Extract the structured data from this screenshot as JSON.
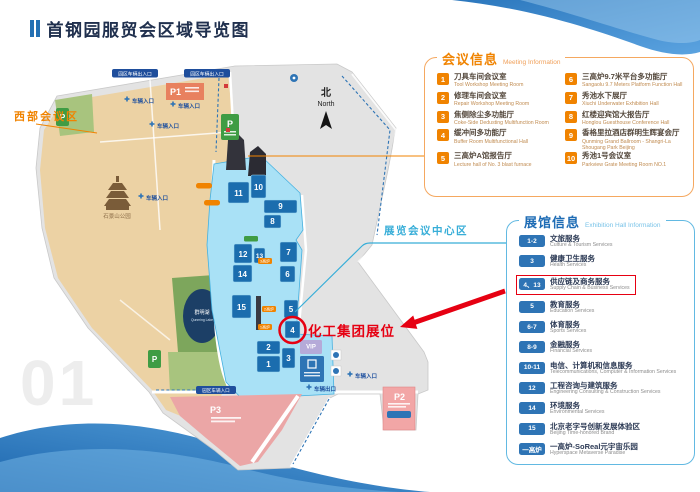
{
  "page": {
    "title": "首钢园服贸会区域导览图",
    "watermark": "01"
  },
  "colors": {
    "accent_orange": "#f08300",
    "accent_blue": "#2e74b5",
    "highlight_red": "#e60012",
    "teal": "#38aed8"
  },
  "map": {
    "region_west": "西部会议区",
    "region_center": "展览会议中心区",
    "compass": {
      "zh": "北",
      "en": "North"
    },
    "annotation_booth": "化工集团展位",
    "park_name": "石景山公园",
    "lake": {
      "zh": "群明湖",
      "en": "Qunming Lake"
    },
    "entrances": {
      "gate_inout": "园区车辆出入口",
      "gate_in": "园区车辆入口",
      "vehicle_in": "车辆入口",
      "vehicle_out": "车辆出口"
    },
    "parking": {
      "p1": "P1",
      "p2": "P2",
      "p3": "P3",
      "p": "P"
    },
    "buildings": {
      "n1": "1",
      "n2": "2",
      "n3": "3",
      "n4": "4",
      "n5": "5",
      "n6": "6",
      "n7": "7",
      "n8": "8",
      "n9": "9",
      "n10": "10",
      "n11": "11",
      "n12": "12",
      "n13": "13",
      "n14": "14",
      "n15": "15",
      "vip": "VIP"
    },
    "furnaces": {
      "f1": "1高炉",
      "f2": "2高炉",
      "f3": "3高炉"
    }
  },
  "meeting_info": {
    "title_zh": "会议信息",
    "title_en": "Meeting Information",
    "items": [
      {
        "num": "1",
        "zh": "刀具车间会议室",
        "en": "Tool Workshop Meeting Room"
      },
      {
        "num": "2",
        "zh": "修理车间会议室",
        "en": "Repair Workshop Meeting Room"
      },
      {
        "num": "3",
        "zh": "焦侧除尘多功能厅",
        "en": "Coke-Side Dedusting Multifunction Room"
      },
      {
        "num": "4",
        "zh": "缓冲间多功能厅",
        "en": "Buffer Room Multifunctional Hall"
      },
      {
        "num": "5",
        "zh": "三高炉A馆报告厅",
        "en": "Lecture hall of No. 3 blast furnace"
      },
      {
        "num": "6",
        "zh": "三高炉9.7米平台多功能厅",
        "en": "Sangaolu 9.7 Meters Platform Function Hall"
      },
      {
        "num": "7",
        "zh": "秀池水下展厅",
        "en": "Xiuchi Underwater Exhibition Hall"
      },
      {
        "num": "8",
        "zh": "红楼迎宾馆大报告厅",
        "en": "Honglou Guesthouse Conference Hall"
      },
      {
        "num": "9",
        "zh": "香格里拉酒店群明生辉宴会厅",
        "en": "Qunming Grand Ballroom - Shangri-La Shougang Park Beijing"
      },
      {
        "num": "10",
        "zh": "秀池1号会议室",
        "en": "Parkview Grate Meeting Room NO.1"
      }
    ]
  },
  "hall_info": {
    "title_zh": "展馆信息",
    "title_en": "Exhibition Hall Information",
    "items": [
      {
        "badge": "1-2",
        "zh": "文旅服务",
        "en": "Culture & Tourism Services",
        "highlight": false
      },
      {
        "badge": "3",
        "zh": "健康卫生服务",
        "en": "Health Services",
        "highlight": false
      },
      {
        "badge": "4、13",
        "zh": "供应链及商务服务",
        "en": "Supply Chain & Business Services",
        "highlight": true
      },
      {
        "badge": "5",
        "zh": "教育服务",
        "en": "Education Services",
        "highlight": false
      },
      {
        "badge": "6-7",
        "zh": "体育服务",
        "en": "Sports Services",
        "highlight": false
      },
      {
        "badge": "8-9",
        "zh": "金融服务",
        "en": "Financial Services",
        "highlight": false
      },
      {
        "badge": "10-11",
        "zh": "电信、计算机和信息服务",
        "en": "Telecommunications, Computer & Information Services",
        "highlight": false
      },
      {
        "badge": "12",
        "zh": "工程咨询与建筑服务",
        "en": "Engineering Consulting & Construction Services",
        "highlight": false
      },
      {
        "badge": "14",
        "zh": "环境服务",
        "en": "Environmental Services",
        "highlight": false
      },
      {
        "badge": "15",
        "zh": "北京老字号创新发展体验区",
        "en": "Beijing Time-honored Brand",
        "highlight": false
      },
      {
        "badge": "一高炉",
        "zh": "一高炉-SoReal元宇宙乐园",
        "en": "Hyperspace Metaverse Paradise",
        "highlight": false
      }
    ]
  }
}
